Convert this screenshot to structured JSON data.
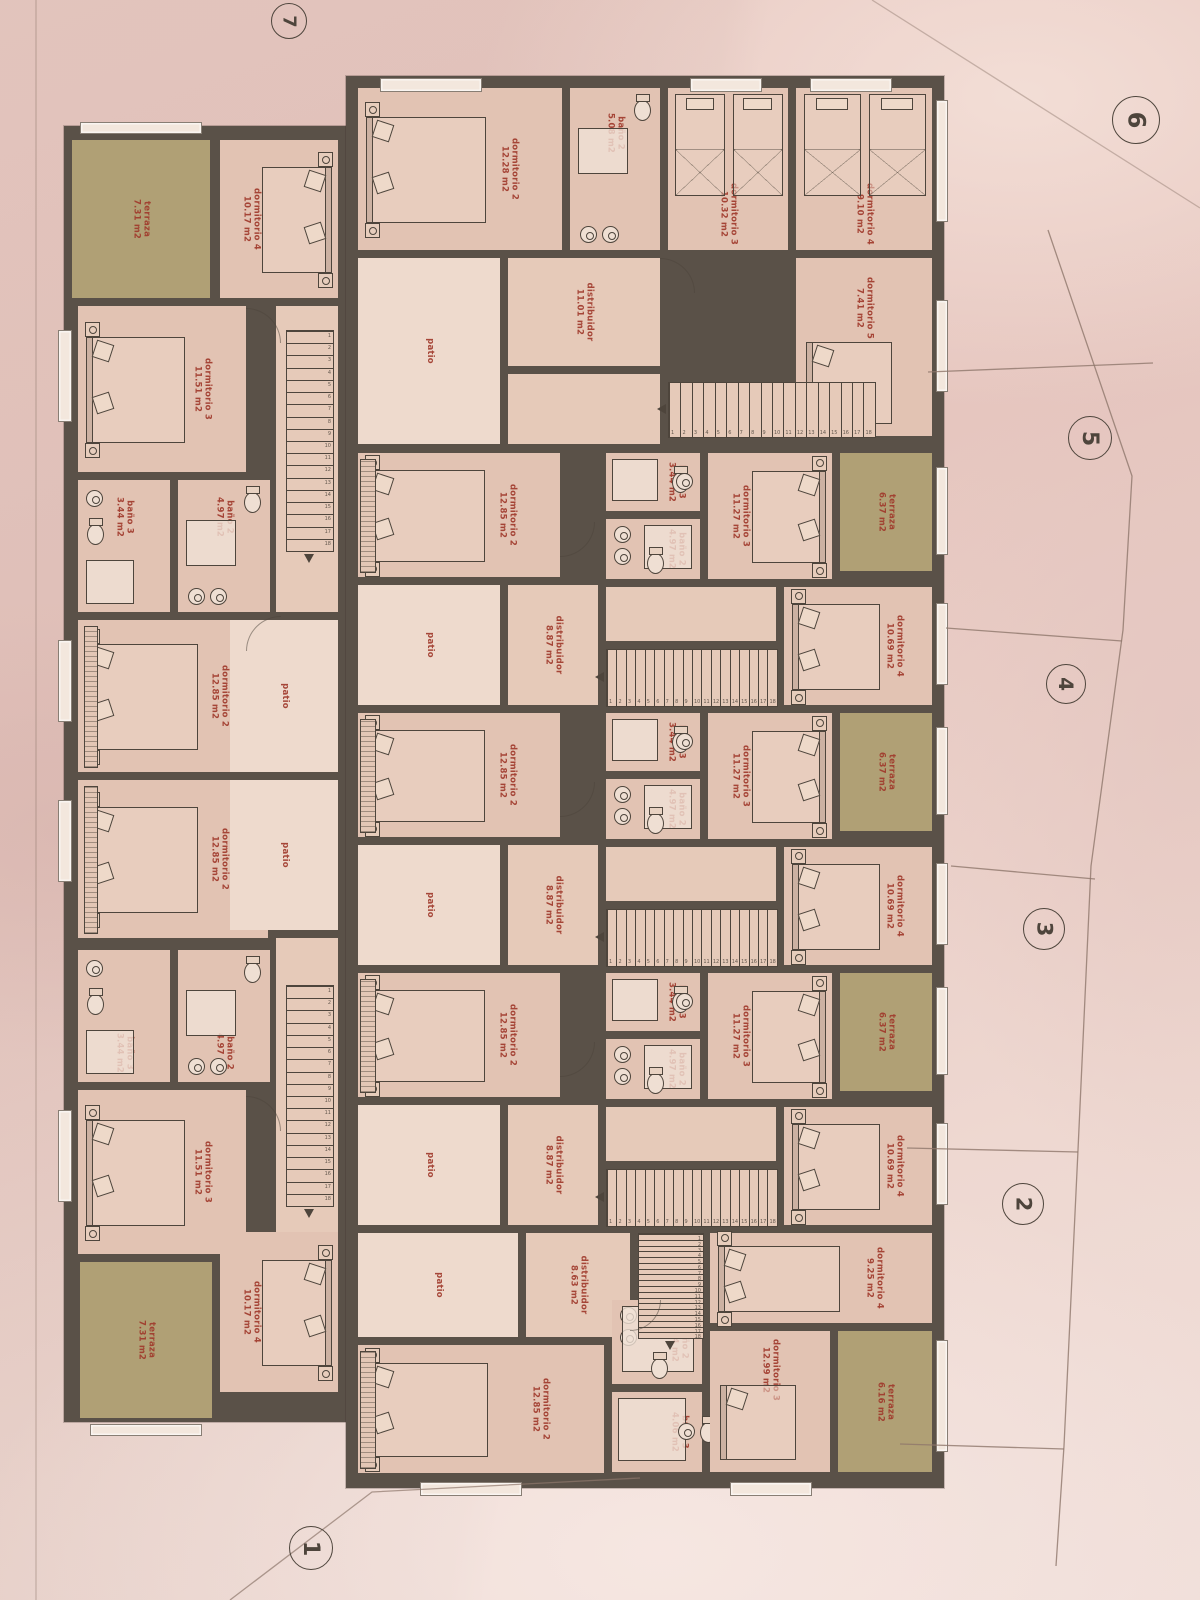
{
  "palette": {
    "paper": "#e9cbc4",
    "wall": "#5a5148",
    "room": "#e2c3b3",
    "hall": "#e6cab9",
    "patio": "#eedacd",
    "terrace": "#b0a075",
    "label": "#a03a2c",
    "ink": "#4e453c",
    "boundary": "#8f776c"
  },
  "lot_markers": [
    "7",
    "6",
    "5",
    "4",
    "3",
    "2",
    "1"
  ],
  "stairs": {
    "steps": 18
  },
  "units": [
    {
      "id": "left-top",
      "rooms": [
        {
          "name": "terraza",
          "area": "7.31 m2"
        },
        {
          "name": "dormitorio 4",
          "area": "10.17 m2"
        },
        {
          "name": "dormitorio 3",
          "area": "11.51 m2"
        },
        {
          "name": "baño 3",
          "area": "3.44 m2"
        },
        {
          "name": "baño 2",
          "area": "4.97 m2"
        },
        {
          "name": "dormitorio 2",
          "area": "12.85 m2"
        },
        {
          "name": "distribuidor",
          "area": "9.71 m2"
        },
        {
          "name": "patio",
          "area": ""
        }
      ]
    },
    {
      "id": "left-bottom",
      "rooms": [
        {
          "name": "dormitorio 2",
          "area": "12.85 m2"
        },
        {
          "name": "patio",
          "area": ""
        },
        {
          "name": "distribuidor",
          "area": "9.71 m2"
        },
        {
          "name": "baño 2",
          "area": "4.97 m2"
        },
        {
          "name": "baño 3",
          "area": "3.44 m2"
        },
        {
          "name": "dormitorio 3",
          "area": "11.51 m2"
        },
        {
          "name": "dormitorio 4",
          "area": "10.17 m2"
        },
        {
          "name": "terraza",
          "area": "7.31 m2"
        }
      ]
    },
    {
      "id": "top",
      "rooms": [
        {
          "name": "dormitorio 2",
          "area": "12.28 m2"
        },
        {
          "name": "baño 2",
          "area": "5.08 m2"
        },
        {
          "name": "dormitorio 3",
          "area": "10.32 m2"
        },
        {
          "name": "dormitorio 4",
          "area": "9.10 m2"
        },
        {
          "name": "distribuidor",
          "area": "11.01 m2"
        },
        {
          "name": "dormitorio 5",
          "area": "7.41 m2"
        },
        {
          "name": "patio",
          "area": ""
        }
      ]
    },
    {
      "id": "row-b",
      "rooms": [
        {
          "name": "dormitorio 2",
          "area": "12.85 m2"
        },
        {
          "name": "baño 3",
          "area": "3.44 m2"
        },
        {
          "name": "baño 2",
          "area": "4.97 m2"
        },
        {
          "name": "dormitorio 3",
          "area": "11.27 m2"
        },
        {
          "name": "terraza",
          "area": "6.37 m2"
        },
        {
          "name": "dormitorio 4",
          "area": "10.69 m2"
        },
        {
          "name": "distribuidor",
          "area": "8.87 m2"
        },
        {
          "name": "patio",
          "area": ""
        }
      ]
    },
    {
      "id": "row-c",
      "rooms": [
        {
          "name": "dormitorio 2",
          "area": "12.85 m2"
        },
        {
          "name": "baño 3",
          "area": "3.44 m2"
        },
        {
          "name": "baño 2",
          "area": "4.97 m2"
        },
        {
          "name": "dormitorio 3",
          "area": "11.27 m2"
        },
        {
          "name": "terraza",
          "area": "6.37 m2"
        },
        {
          "name": "dormitorio 4",
          "area": "10.69 m2"
        },
        {
          "name": "distribuidor",
          "area": "8.87 m2"
        },
        {
          "name": "patio",
          "area": ""
        }
      ]
    },
    {
      "id": "row-d",
      "rooms": [
        {
          "name": "dormitorio 2",
          "area": "12.85 m2"
        },
        {
          "name": "baño 3",
          "area": "3.44 m2"
        },
        {
          "name": "baño 2",
          "area": "4.97 m2"
        },
        {
          "name": "dormitorio 3",
          "area": "11.27 m2"
        },
        {
          "name": "terraza",
          "area": "6.37 m2"
        },
        {
          "name": "dormitorio 4",
          "area": "10.69 m2"
        },
        {
          "name": "distribuidor",
          "area": "8.87 m2"
        },
        {
          "name": "patio",
          "area": ""
        }
      ]
    },
    {
      "id": "bottom",
      "rooms": [
        {
          "name": "dormitorio 4",
          "area": "9.25 m2"
        },
        {
          "name": "distribuidor",
          "area": "8.63 m2"
        },
        {
          "name": "patio",
          "area": ""
        },
        {
          "name": "dormitorio 2",
          "area": "12.85 m2"
        },
        {
          "name": "baño 2",
          "area": "5.04 m2"
        },
        {
          "name": "baño 3",
          "area": "4.06 m2"
        },
        {
          "name": "dormitorio 3",
          "area": "12.99 m2"
        },
        {
          "name": "terraza",
          "area": "6.16 m2"
        }
      ]
    }
  ]
}
